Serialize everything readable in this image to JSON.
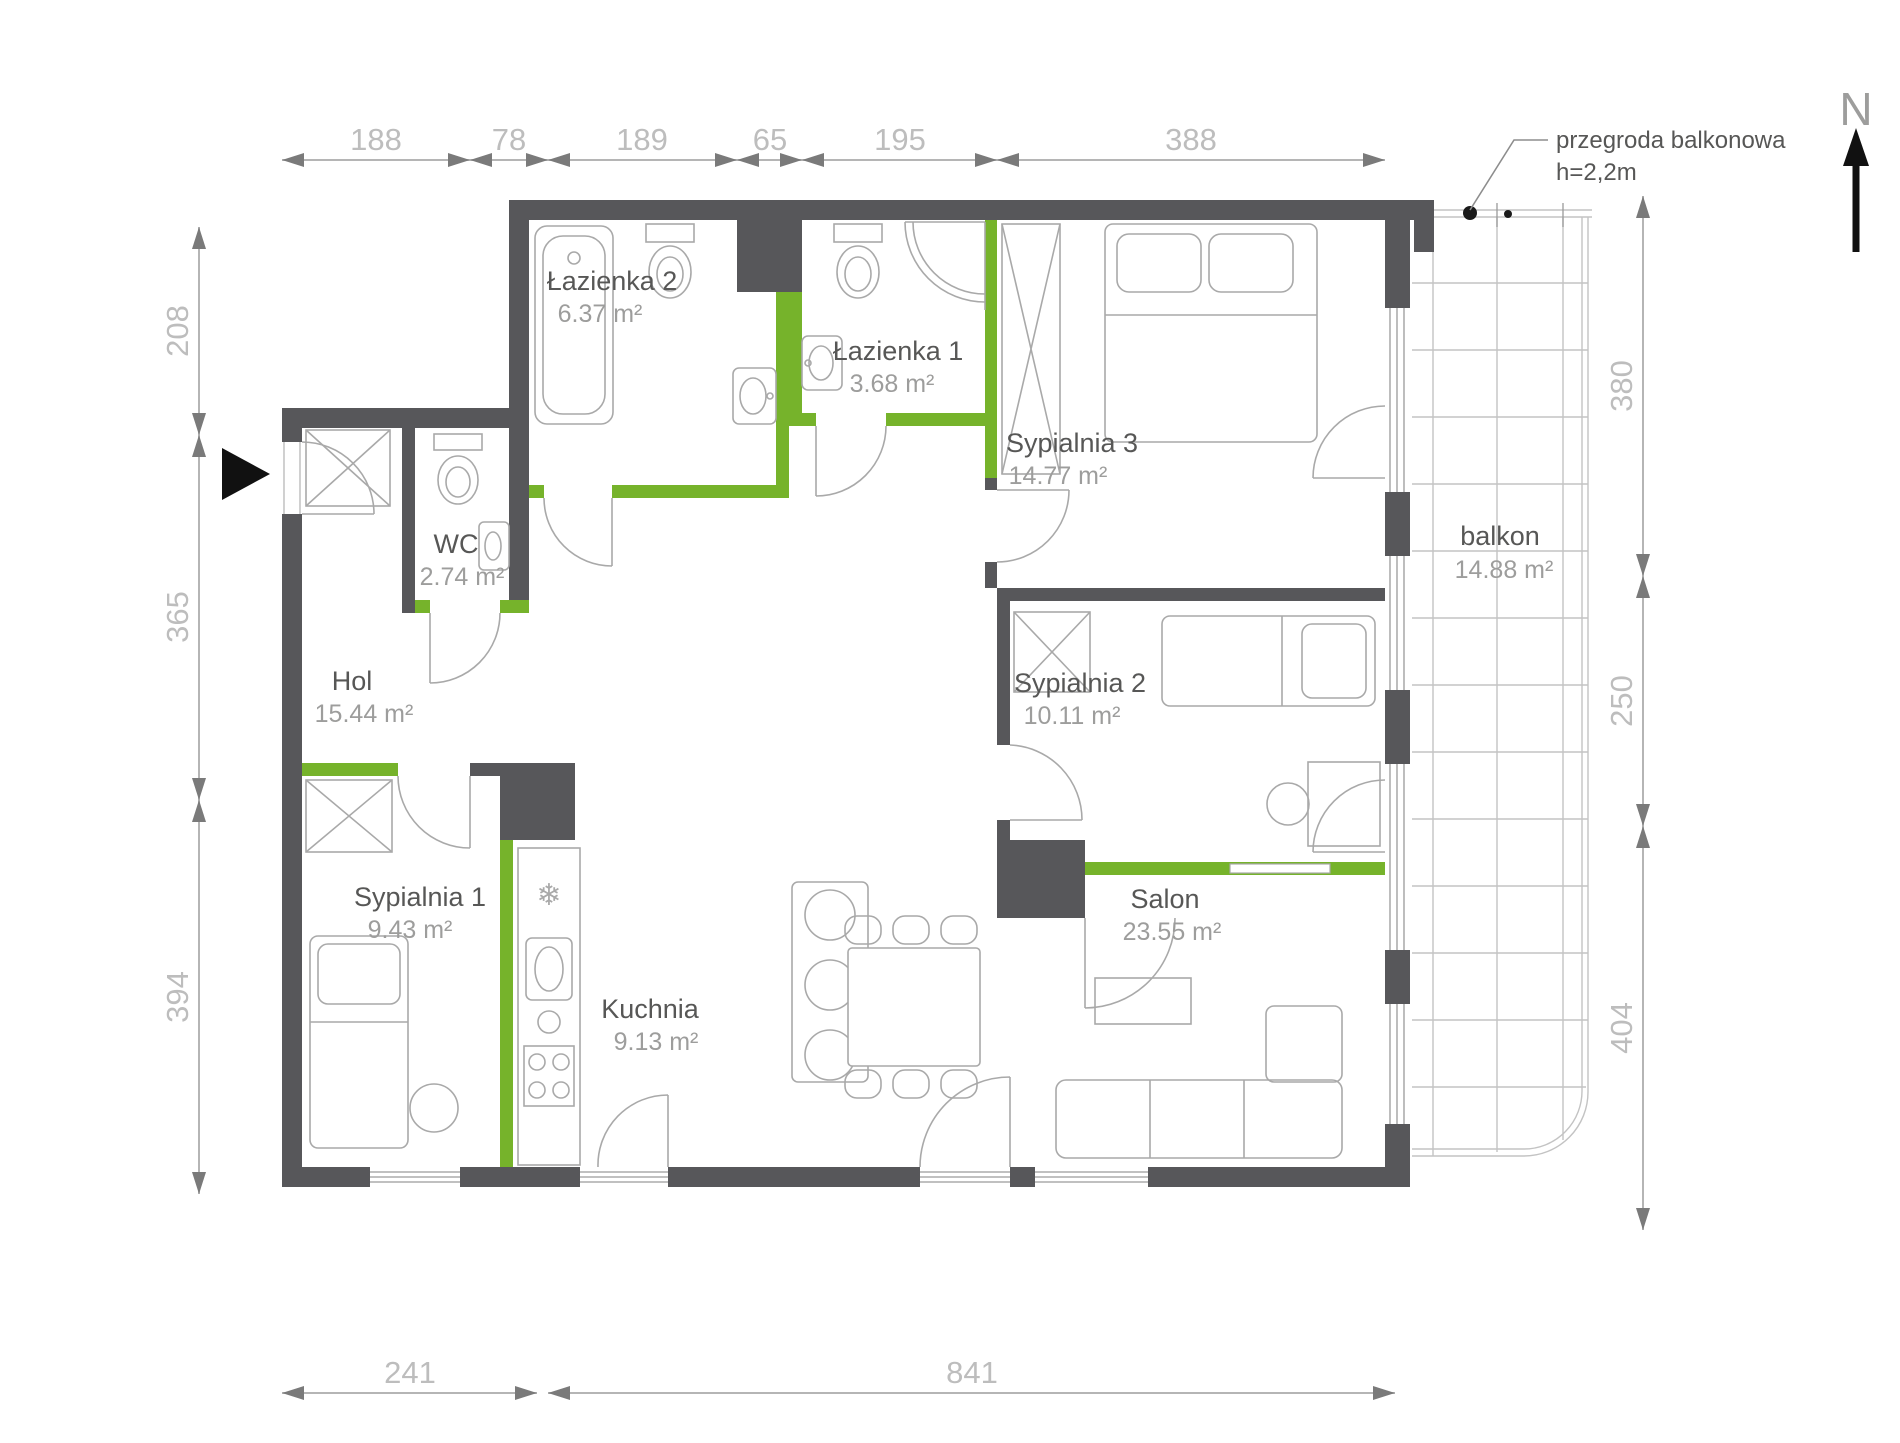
{
  "north": {
    "label": "N"
  },
  "annotation": {
    "line1": "przegroda balkonowa",
    "line2": "h=2,2m"
  },
  "rooms": {
    "lazienka2": {
      "name": "Łazienka 2",
      "area": "6.37 m²"
    },
    "lazienka1": {
      "name": "Łazienka 1",
      "area": "3.68 m²"
    },
    "sypialnia3": {
      "name": "Sypialnia 3",
      "area": "14.77 m²"
    },
    "wc": {
      "name": "WC",
      "area": "2.74 m²"
    },
    "hol": {
      "name": "Hol",
      "area": "15.44 m²"
    },
    "sypialnia2": {
      "name": "Sypialnia 2",
      "area": "10.11 m²"
    },
    "sypialnia1": {
      "name": "Sypialnia 1",
      "area": "9.43 m²"
    },
    "kuchnia": {
      "name": "Kuchnia",
      "area": "9.13 m²"
    },
    "salon": {
      "name": "Salon",
      "area": "23.55 m²"
    },
    "balkon": {
      "name": "balkon",
      "area": "14.88 m²"
    }
  },
  "dimensions": {
    "top": [
      "188",
      "78",
      "189",
      "65",
      "195",
      "388"
    ],
    "left": [
      "208",
      "365",
      "394"
    ],
    "right": [
      "380",
      "250",
      "404"
    ],
    "bottom": [
      "241",
      "841"
    ]
  },
  "colors": {
    "wall": "#57575a",
    "partition": "#76b32b",
    "dimension": "#b5b5b5",
    "room_text": "#575756",
    "area_text": "#9d9d9c"
  }
}
